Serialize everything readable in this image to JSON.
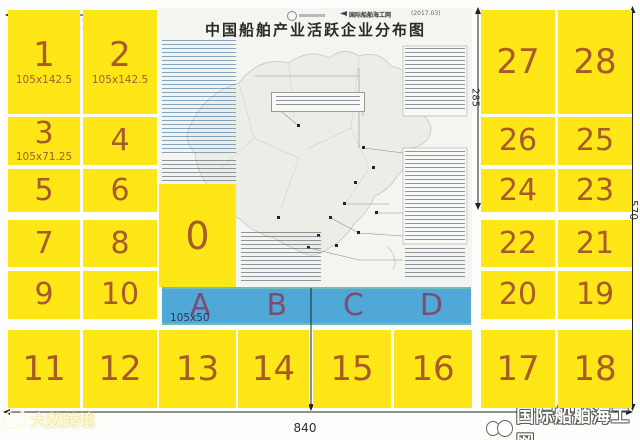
{
  "map": {
    "title": "中国船舶产业活跃企业分布图",
    "publisher": "国际船舶海工网",
    "date": "(2017.03)"
  },
  "panels": {
    "left_rows": [
      [
        {
          "label": "1",
          "size": "105x142.5"
        },
        {
          "label": "2",
          "size": "105x142.5"
        }
      ],
      [
        {
          "label": "3",
          "size": "105x71.25"
        },
        {
          "label": "4"
        }
      ],
      [
        {
          "label": "5"
        },
        {
          "label": "6"
        }
      ],
      [
        {
          "label": "7"
        },
        {
          "label": "8"
        }
      ],
      [
        {
          "label": "9"
        },
        {
          "label": "10"
        }
      ]
    ],
    "right_rows": [
      [
        {
          "label": "27"
        },
        {
          "label": "28"
        }
      ],
      [
        {
          "label": "26"
        },
        {
          "label": "25"
        }
      ],
      [
        {
          "label": "24"
        },
        {
          "label": "23"
        }
      ],
      [
        {
          "label": "22"
        },
        {
          "label": "21"
        }
      ],
      [
        {
          "label": "20"
        },
        {
          "label": "19"
        }
      ]
    ],
    "bottom_row": [
      "11",
      "12",
      "13",
      "14",
      "15",
      "16",
      "17",
      "18"
    ],
    "zero_label": "0"
  },
  "blue_strip": {
    "letters": [
      "A",
      "B",
      "C",
      "D"
    ],
    "size_label": "105x50"
  },
  "dimensions": {
    "top_width": "210",
    "right_inner_height": "285",
    "full_height": "570",
    "full_width": "840",
    "center_height": "192.5"
  },
  "watermarks": {
    "bottom_left": "大数跨境",
    "bottom_right": "国际船舶海工网"
  },
  "colors": {
    "panel_yellow": "#ffe617",
    "strip_blue": "#4fa8d5",
    "number_orange": "#a85a28",
    "letter_purple": "#7c4c74",
    "dimension_dark": "#2e2e2e"
  }
}
